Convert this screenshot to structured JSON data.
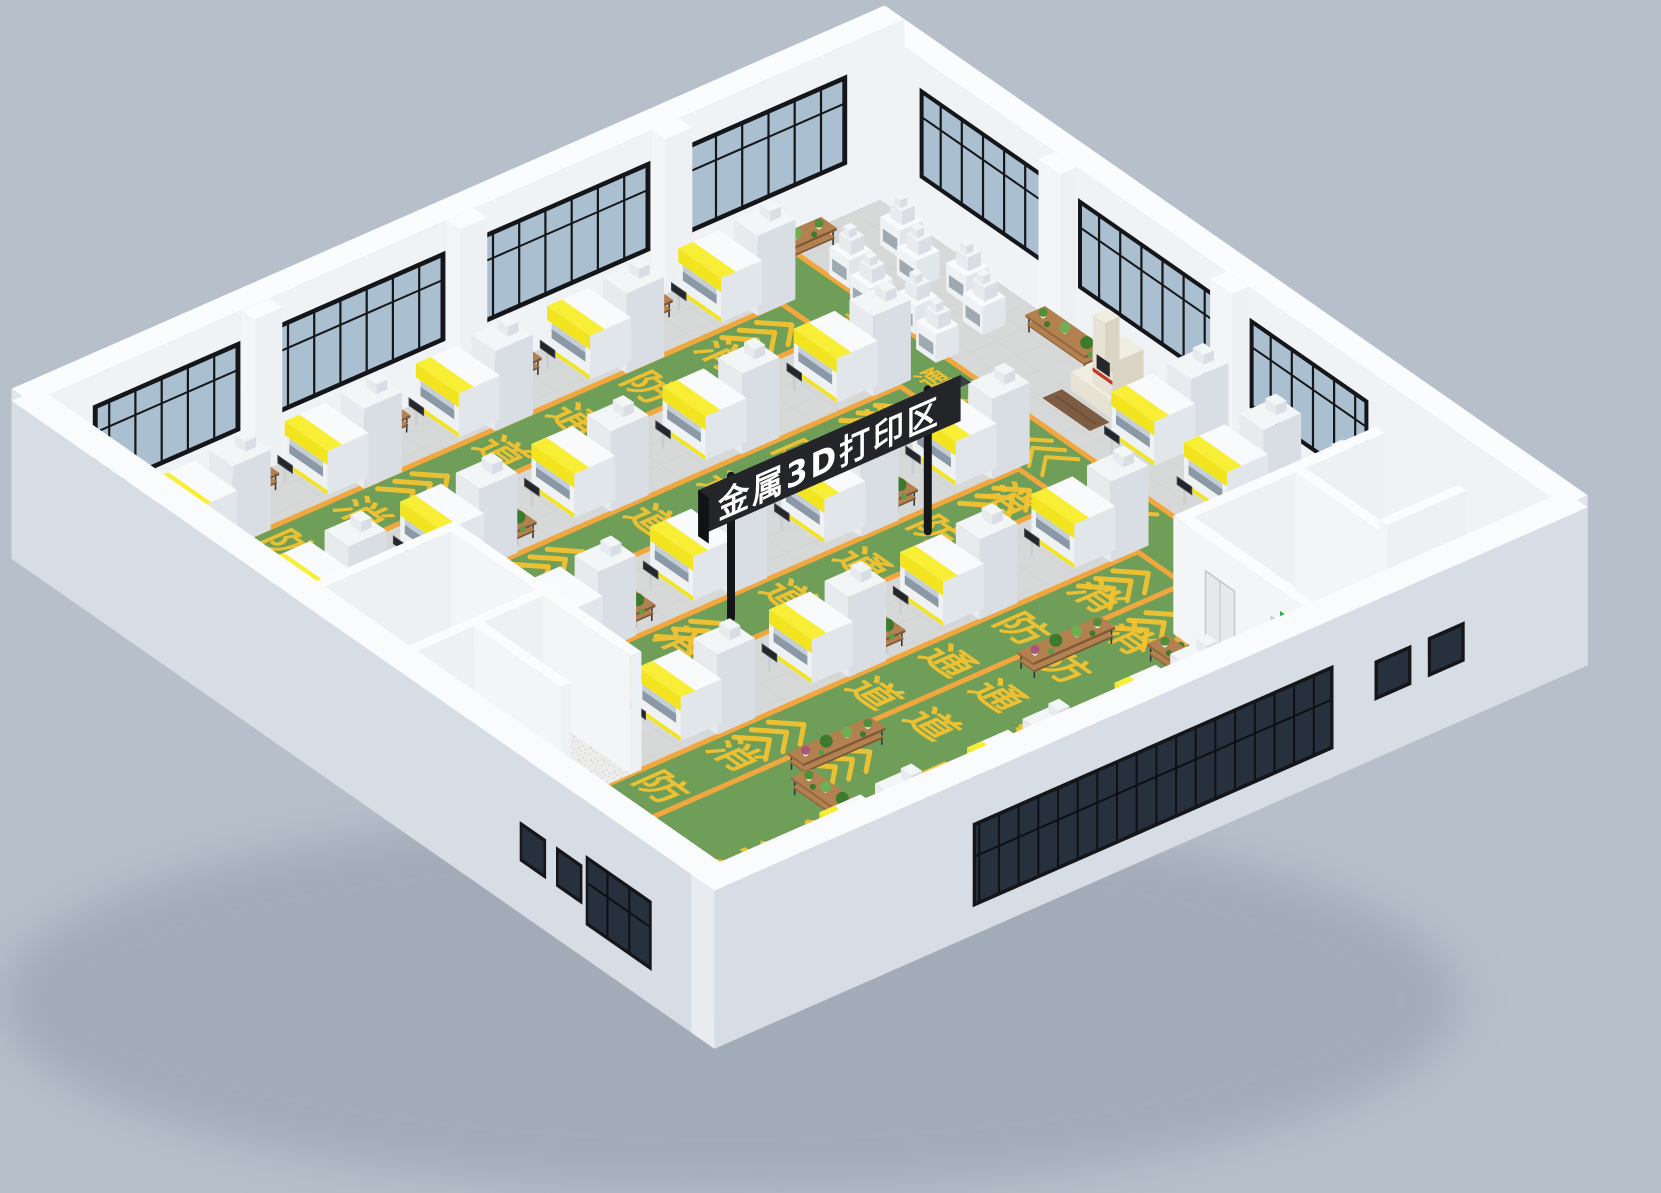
{
  "sign": {
    "text": "金属3D打印区"
  },
  "floor_markings": {
    "phrase": "消防通道",
    "chars": [
      "消",
      "防",
      "通",
      "道"
    ]
  },
  "colors": {
    "background": "#b6bfca",
    "floor": "#d7d9d8",
    "tile_line": "#c9cccb",
    "green": "#6f9e59",
    "orange": "#f2a73e",
    "marking": "#f2c231",
    "glass": "#aabfd0",
    "glass_dark": "#27313d",
    "frame": "#14161a",
    "machine_yellow": "#f2e41f",
    "machine_glass": "#8b99a7",
    "sign_black": "#232528",
    "pole": "#141619",
    "wood": "#ab7a50",
    "plant": "#4f8f3b",
    "rail": "#b4bac0",
    "exit_green": "#27b04c",
    "door": "#e6e9eb",
    "beige": "#ece8da",
    "red": "#c0392b",
    "wall_white": "#f3f5f7"
  },
  "scene": {
    "origin": [
      880,
      200
    ],
    "U": [
      6.6,
      4.6
    ],
    "V": [
      -8.2,
      3.6
    ],
    "far_wall_height": 170,
    "near_wall_height": 158,
    "room_wall_height": 118,
    "aisles": [
      {
        "pts": [
          [
            2,
            12
          ],
          [
            76,
            12
          ],
          [
            76,
            18.5
          ],
          [
            2,
            18.5
          ]
        ]
      },
      {
        "pts": [
          [
            8,
            18.5
          ],
          [
            15,
            18.5
          ],
          [
            15,
            100
          ],
          [
            8,
            100
          ]
        ]
      },
      {
        "pts": [
          [
            26,
            18.5
          ],
          [
            33,
            18.5
          ],
          [
            33,
            100
          ],
          [
            26,
            100
          ]
        ]
      },
      {
        "pts": [
          [
            44,
            18.5
          ],
          [
            51,
            18.5
          ],
          [
            51,
            79.2
          ],
          [
            44,
            79.2
          ]
        ]
      },
      {
        "pts": [
          [
            62,
            18.5
          ],
          [
            69,
            18.5
          ],
          [
            69,
            100
          ],
          [
            62,
            100
          ]
        ]
      },
      {
        "pts": [
          [
            69,
            18.5
          ],
          [
            76,
            18.5
          ],
          [
            76,
            25
          ],
          [
            100,
            25
          ],
          [
            100,
            100
          ],
          [
            69,
            100
          ]
        ]
      }
    ],
    "marking_texts": [
      [
        11.5,
        30,
        42,
        "v",
        0
      ],
      [
        11.5,
        39,
        42,
        "v",
        1
      ],
      [
        11.5,
        48,
        42,
        "v",
        2
      ],
      [
        11.5,
        57,
        42,
        "v",
        3
      ],
      [
        11.5,
        74,
        42,
        "v",
        0
      ],
      [
        11.5,
        83,
        42,
        "v",
        1
      ],
      [
        11.5,
        92,
        42,
        "v",
        2
      ],
      [
        29.5,
        26,
        42,
        "v",
        0
      ],
      [
        29.5,
        35,
        42,
        "v",
        1
      ],
      [
        29.5,
        44,
        42,
        "v",
        2
      ],
      [
        29.5,
        53,
        42,
        "v",
        3
      ],
      [
        29.5,
        76,
        42,
        "v",
        0
      ],
      [
        29.5,
        85,
        42,
        "v",
        1
      ],
      [
        29.5,
        94,
        42,
        "v",
        2
      ],
      [
        47.5,
        24,
        42,
        "v",
        0
      ],
      [
        47.5,
        33,
        42,
        "v",
        1
      ],
      [
        47.5,
        42,
        42,
        "v",
        2
      ],
      [
        47.5,
        51,
        42,
        "v",
        3
      ],
      [
        47.5,
        64,
        42,
        "v",
        0
      ],
      [
        47.5,
        72,
        42,
        "v",
        1
      ],
      [
        65.5,
        28,
        42,
        "v",
        0
      ],
      [
        65.5,
        37,
        42,
        "v",
        1
      ],
      [
        65.5,
        46,
        42,
        "v",
        2
      ],
      [
        65.5,
        55,
        42,
        "v",
        3
      ],
      [
        65.5,
        72,
        42,
        "v",
        0
      ],
      [
        65.5,
        81,
        42,
        "v",
        1
      ],
      [
        65.5,
        90,
        42,
        "v",
        2
      ],
      [
        82,
        50,
        62,
        "v",
        0
      ],
      [
        82,
        61,
        62,
        "v",
        1
      ],
      [
        82,
        72,
        62,
        "v",
        2
      ],
      [
        82,
        83,
        62,
        "v",
        3
      ],
      [
        73,
        30,
        42,
        "v",
        0
      ],
      [
        73,
        38,
        42,
        "v",
        1
      ],
      [
        73,
        46,
        42,
        "v",
        2
      ],
      [
        73,
        54,
        42,
        "v",
        3
      ],
      [
        16,
        15.2,
        26,
        "u",
        0
      ],
      [
        22,
        15.2,
        26,
        "u",
        1
      ],
      [
        28,
        15.2,
        26,
        "u",
        2
      ],
      [
        34,
        15.2,
        26,
        "u",
        3
      ]
    ],
    "chevrons": [
      [
        11.5,
        20,
        "v",
        2.4,
        3,
        2.1,
        5
      ],
      [
        11.5,
        62,
        "v",
        2.4,
        3,
        2.1,
        5
      ],
      [
        11.5,
        96,
        "v",
        2.4,
        2,
        2.1,
        5
      ],
      [
        29.5,
        20,
        "v",
        2.4,
        3,
        2.1,
        5
      ],
      [
        29.5,
        60,
        "v",
        2.4,
        3,
        2.1,
        5
      ],
      [
        29.5,
        96,
        "v",
        2.4,
        2,
        2.1,
        5
      ],
      [
        47.5,
        20,
        "v",
        2.4,
        3,
        2.1,
        5
      ],
      [
        47.5,
        57,
        "v",
        2.4,
        3,
        2.1,
        5
      ],
      [
        47.5,
        74,
        "v",
        2.4,
        2,
        2.1,
        5
      ],
      [
        65.5,
        20,
        "v",
        2.4,
        3,
        2.1,
        5
      ],
      [
        65.5,
        62,
        "v",
        2.4,
        3,
        2.1,
        5
      ],
      [
        65.5,
        96,
        "v",
        2.4,
        2,
        2.1,
        5
      ],
      [
        82,
        40,
        "v",
        3.4,
        3,
        2.6,
        7
      ],
      [
        82,
        90,
        "v",
        3.4,
        3,
        2.6,
        7
      ],
      [
        73,
        22,
        "v",
        2.4,
        3,
        2.1,
        5
      ],
      [
        73,
        60,
        "v",
        2.4,
        3,
        2.1,
        5
      ],
      [
        90,
        60,
        "v",
        3,
        3,
        2.4,
        6
      ],
      [
        92,
        84,
        "v",
        3,
        3,
        2.4,
        6
      ],
      [
        40,
        15.2,
        "u",
        2.2,
        3,
        2,
        4
      ],
      [
        52,
        15.2,
        "u",
        2.2,
        3,
        2,
        4
      ]
    ],
    "machines_big": [
      [
        0.5,
        20
      ],
      [
        0.5,
        36
      ],
      [
        0.5,
        52
      ],
      [
        0.5,
        68
      ],
      [
        0.5,
        84
      ],
      [
        18,
        20
      ],
      [
        18,
        36
      ],
      [
        18,
        52
      ],
      [
        18,
        68
      ],
      [
        18,
        84
      ],
      [
        36,
        20
      ],
      [
        36,
        36
      ],
      [
        36,
        52
      ],
      [
        36,
        68
      ],
      [
        54,
        20
      ],
      [
        54,
        36
      ],
      [
        54,
        52
      ],
      [
        54,
        68
      ],
      [
        45,
        3
      ],
      [
        56,
        3
      ],
      [
        66,
        3
      ],
      [
        84,
        34
      ],
      [
        84,
        52
      ],
      [
        84,
        70
      ]
    ],
    "machines_small": [
      [
        6,
        2
      ],
      [
        11,
        4
      ],
      [
        16,
        2
      ],
      [
        21,
        4
      ],
      [
        7,
        9
      ],
      [
        12,
        10.5
      ],
      [
        17,
        9
      ],
      [
        22,
        10.5
      ]
    ],
    "cmm": [
      36.5,
      1.5
    ],
    "racks": [
      [
        1,
        8,
        8,
        "v"
      ],
      [
        1,
        28,
        6,
        "v"
      ],
      [
        1,
        44,
        6,
        "v"
      ],
      [
        1,
        60,
        6,
        "v"
      ],
      [
        1,
        76,
        6,
        "v"
      ],
      [
        26,
        0.8,
        9,
        "u"
      ],
      [
        35,
        30,
        8,
        "u"
      ],
      [
        53,
        46,
        8,
        "u"
      ],
      [
        17,
        62,
        8,
        "u"
      ],
      [
        35,
        62,
        8,
        "u"
      ],
      [
        70.5,
        30,
        10,
        "v"
      ],
      [
        70.5,
        58,
        10,
        "v"
      ],
      [
        74,
        68,
        10,
        "u"
      ],
      [
        36,
        74,
        9,
        "u"
      ],
      [
        17,
        92,
        8,
        "u"
      ],
      [
        77,
        27,
        8,
        "u"
      ]
    ],
    "pots": [
      [
        80,
        26.5
      ],
      [
        83.5,
        32
      ],
      [
        75,
        95
      ],
      [
        66,
        95
      ]
    ],
    "rooms": {
      "right": {
        "u0": 76,
        "v0": 0,
        "u1": 100,
        "v1": 24
      },
      "bl": {
        "u0": 34,
        "v0": 80,
        "u1": 62,
        "v1": 103
      }
    },
    "windows": {
      "nw": [
        [
          4,
          24
        ],
        [
          28,
          49
        ],
        [
          53,
          74
        ],
        [
          78,
          96
        ]
      ],
      "ne": [
        [
          6,
          26
        ],
        [
          30,
          52
        ],
        [
          56,
          74
        ]
      ],
      "pillars_nw": [
        [
          24.5,
          27.8
        ],
        [
          49.5,
          52.8
        ],
        [
          74.5,
          77.8
        ]
      ],
      "pillars_ne": [
        [
          26.5,
          29.8
        ],
        [
          52.5,
          55.8
        ]
      ],
      "se_band": [
        28,
        72
      ],
      "se_small": [
        [
          12,
          16.5
        ],
        [
          18.5,
          23
        ]
      ],
      "sw_band": [
        84,
        94
      ],
      "sw_small": [
        [
          74,
          78
        ],
        [
          79.5,
          83.5
        ]
      ]
    },
    "sign": {
      "u": 47,
      "v0": 28,
      "v1": 60,
      "h0": 96,
      "h1": 142,
      "poles_v": [
        32,
        56
      ],
      "text_v": 44,
      "text_h": 104,
      "font": 34
    }
  }
}
